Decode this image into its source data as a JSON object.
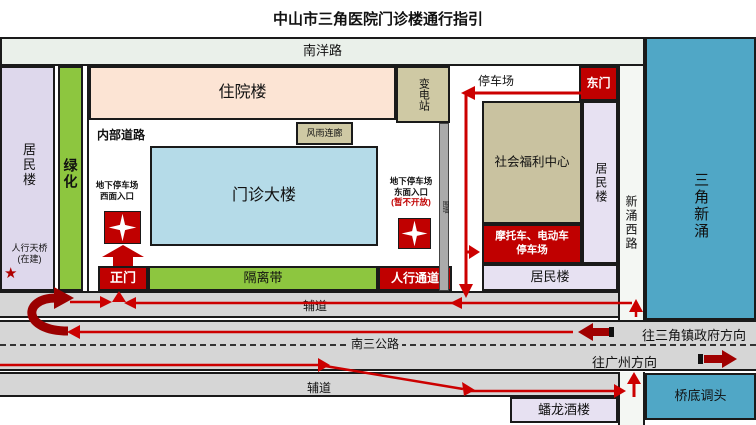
{
  "title": "中山市三角医院门诊楼通行指引",
  "colors": {
    "gate_red": "#c00000",
    "route_red": "#cc0000",
    "uturn_dark_red": "#9b0000",
    "green": "#8dc63f",
    "river_blue": "#50a7c6",
    "inpatient_peach": "#fce4d4",
    "outpatient_blue": "#b5dbe8",
    "tan": "#cfc9a4",
    "lavender": "#ded8ec",
    "road_gray": "#d6d6d6",
    "nanyang_band": "#eaf0ea"
  },
  "roads": {
    "nanyang": "南洋路",
    "service_road_north": "辅道",
    "service_road_south": "辅道",
    "main_road": "南三公路",
    "xinchong_west": "新涌西路",
    "to_sanjiao_gov": "往三角镇政府方向",
    "to_guangzhou": "往广州方向",
    "bridge_uturn": "桥底调头"
  },
  "buildings": {
    "resident_left": "居民楼",
    "greenbelt": "绿化",
    "inpatient": "住院楼",
    "substation": "变电站",
    "internal_road": "内部道路",
    "covered_corridor": "风雨连廊",
    "outpatient": "门诊大楼",
    "parking_lot": "停车场",
    "east_gate": "东门",
    "welfare_center": "社会福利中心",
    "resident_right": "居民楼",
    "resident_bottom": "居民楼",
    "moto_parking_line1": "摩托车、电动车",
    "moto_parking_line2": "停车场",
    "main_gate": "正门",
    "separation_belt": "隔离带",
    "pedestrian_passage": "人行通道",
    "wall": "围墙",
    "panlong_restaurant": "蟠龙酒楼",
    "river": "三角新涌"
  },
  "annotations": {
    "west_entrance_line1": "地下停车场",
    "west_entrance_line2": "西面入口",
    "east_entrance_line1": "地下停车场",
    "east_entrance_line2": "东面入口",
    "east_entrance_line3": "(暂不开放)",
    "footbridge_line1": "人行天桥",
    "footbridge_line2": "(在建)",
    "star": "★"
  }
}
